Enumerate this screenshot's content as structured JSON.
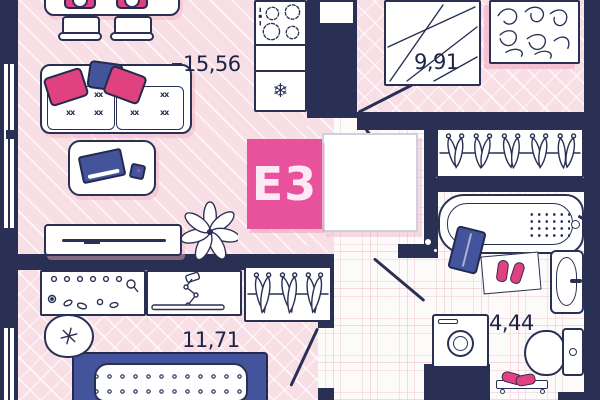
{
  "unit": {
    "label": "E3"
  },
  "rooms": {
    "living": {
      "area": "15,56"
    },
    "bedroom_top": {
      "area": "9,91"
    },
    "bedroom_bottom": {
      "area": "11,71"
    },
    "bathroom": {
      "area": "4,44"
    }
  },
  "decor": {
    "sofa_stitch": "xx",
    "snowflake": "❄"
  },
  "colors": {
    "wall": "#2a3054",
    "accent_pink": "#e8519b",
    "pink_dark": "#e0417f",
    "accent_blue": "#44549c",
    "floor_pink": "#f8dee5",
    "text": "#1d2445"
  }
}
